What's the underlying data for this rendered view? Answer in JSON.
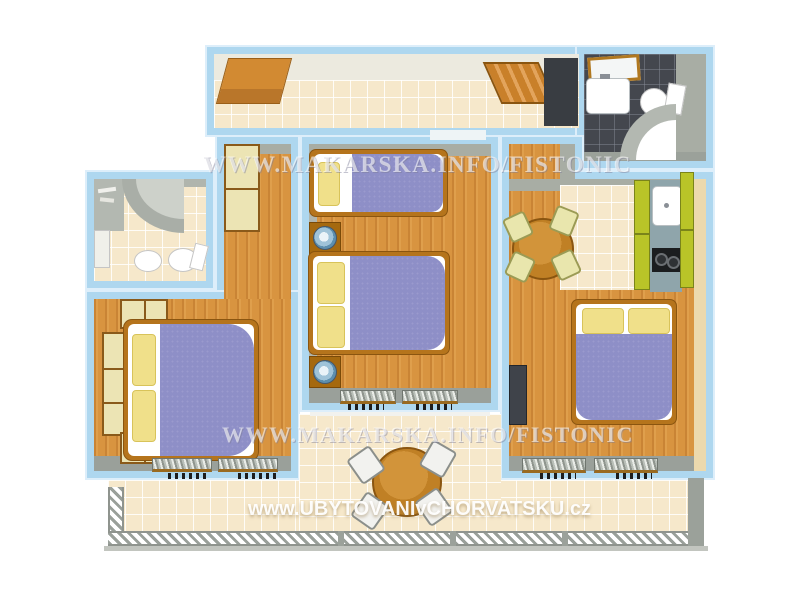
{
  "watermarks": {
    "makarska_top": "WWW.MAKARSKA.INFO/FISTONIC",
    "makarska_middle": "WWW.MAKARSKA.INFO/FISTONIC",
    "ubytovani": "www.UBYTOVANIvCHORVATSKU.cz"
  },
  "colors": {
    "wall": "#aed7ef",
    "wood": "#d89440",
    "tile": "#f6e8cb",
    "darktile": "#44474e",
    "graywall": "#a8ada4",
    "bedframe": "#b5741c",
    "blanket": "#8e8fc7",
    "pillow": "#f0e08a",
    "cabinet": "#ece4b4",
    "kgreen": "#b9c428",
    "counter": "#8fa5ab",
    "tablewood": "#c08025",
    "chair": "#e9e6ad",
    "stove": "#1b1d1f"
  }
}
